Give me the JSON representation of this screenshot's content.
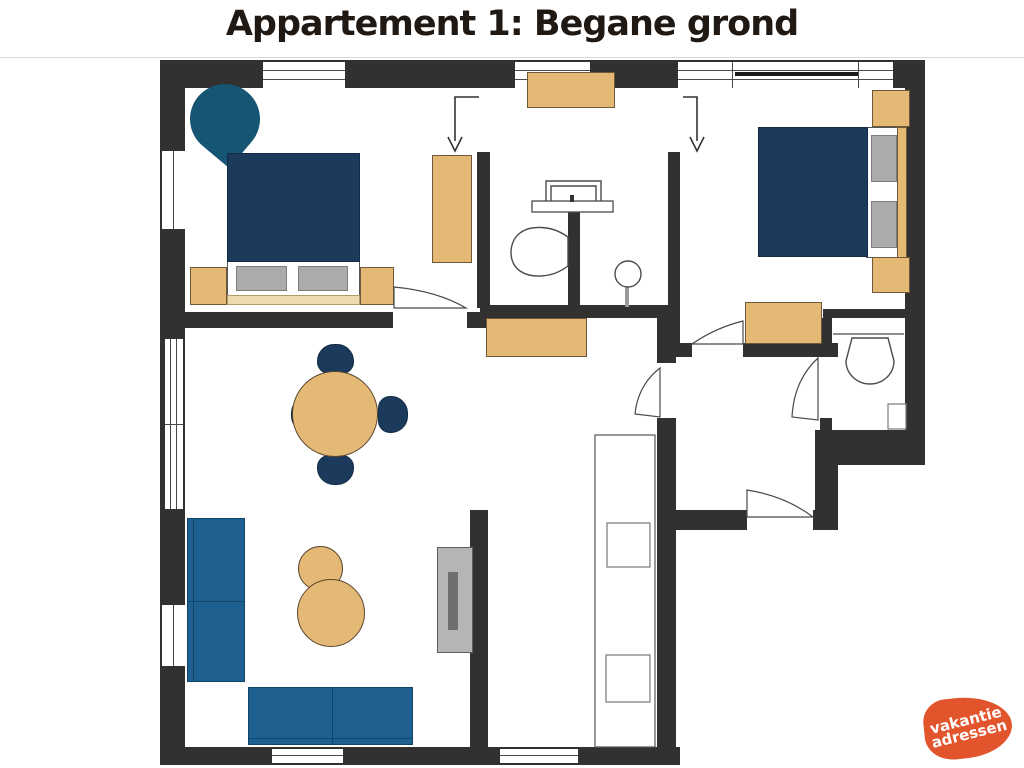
{
  "title": "Appartement 1: Begane grond",
  "logo": {
    "line1": "vakantie",
    "line2": "adressen"
  },
  "colors": {
    "wall": "#333130",
    "navy": "#1b3a5c",
    "teal": "#175574",
    "blue": "#1e6190",
    "tan": "#e3b975",
    "tan-light": "#eddbb0",
    "pillow": "#ababab",
    "tv": "#b5b5b5",
    "tv-dark": "#6f6f6f",
    "orange": "#e2542b",
    "title-color": "#201813"
  }
}
